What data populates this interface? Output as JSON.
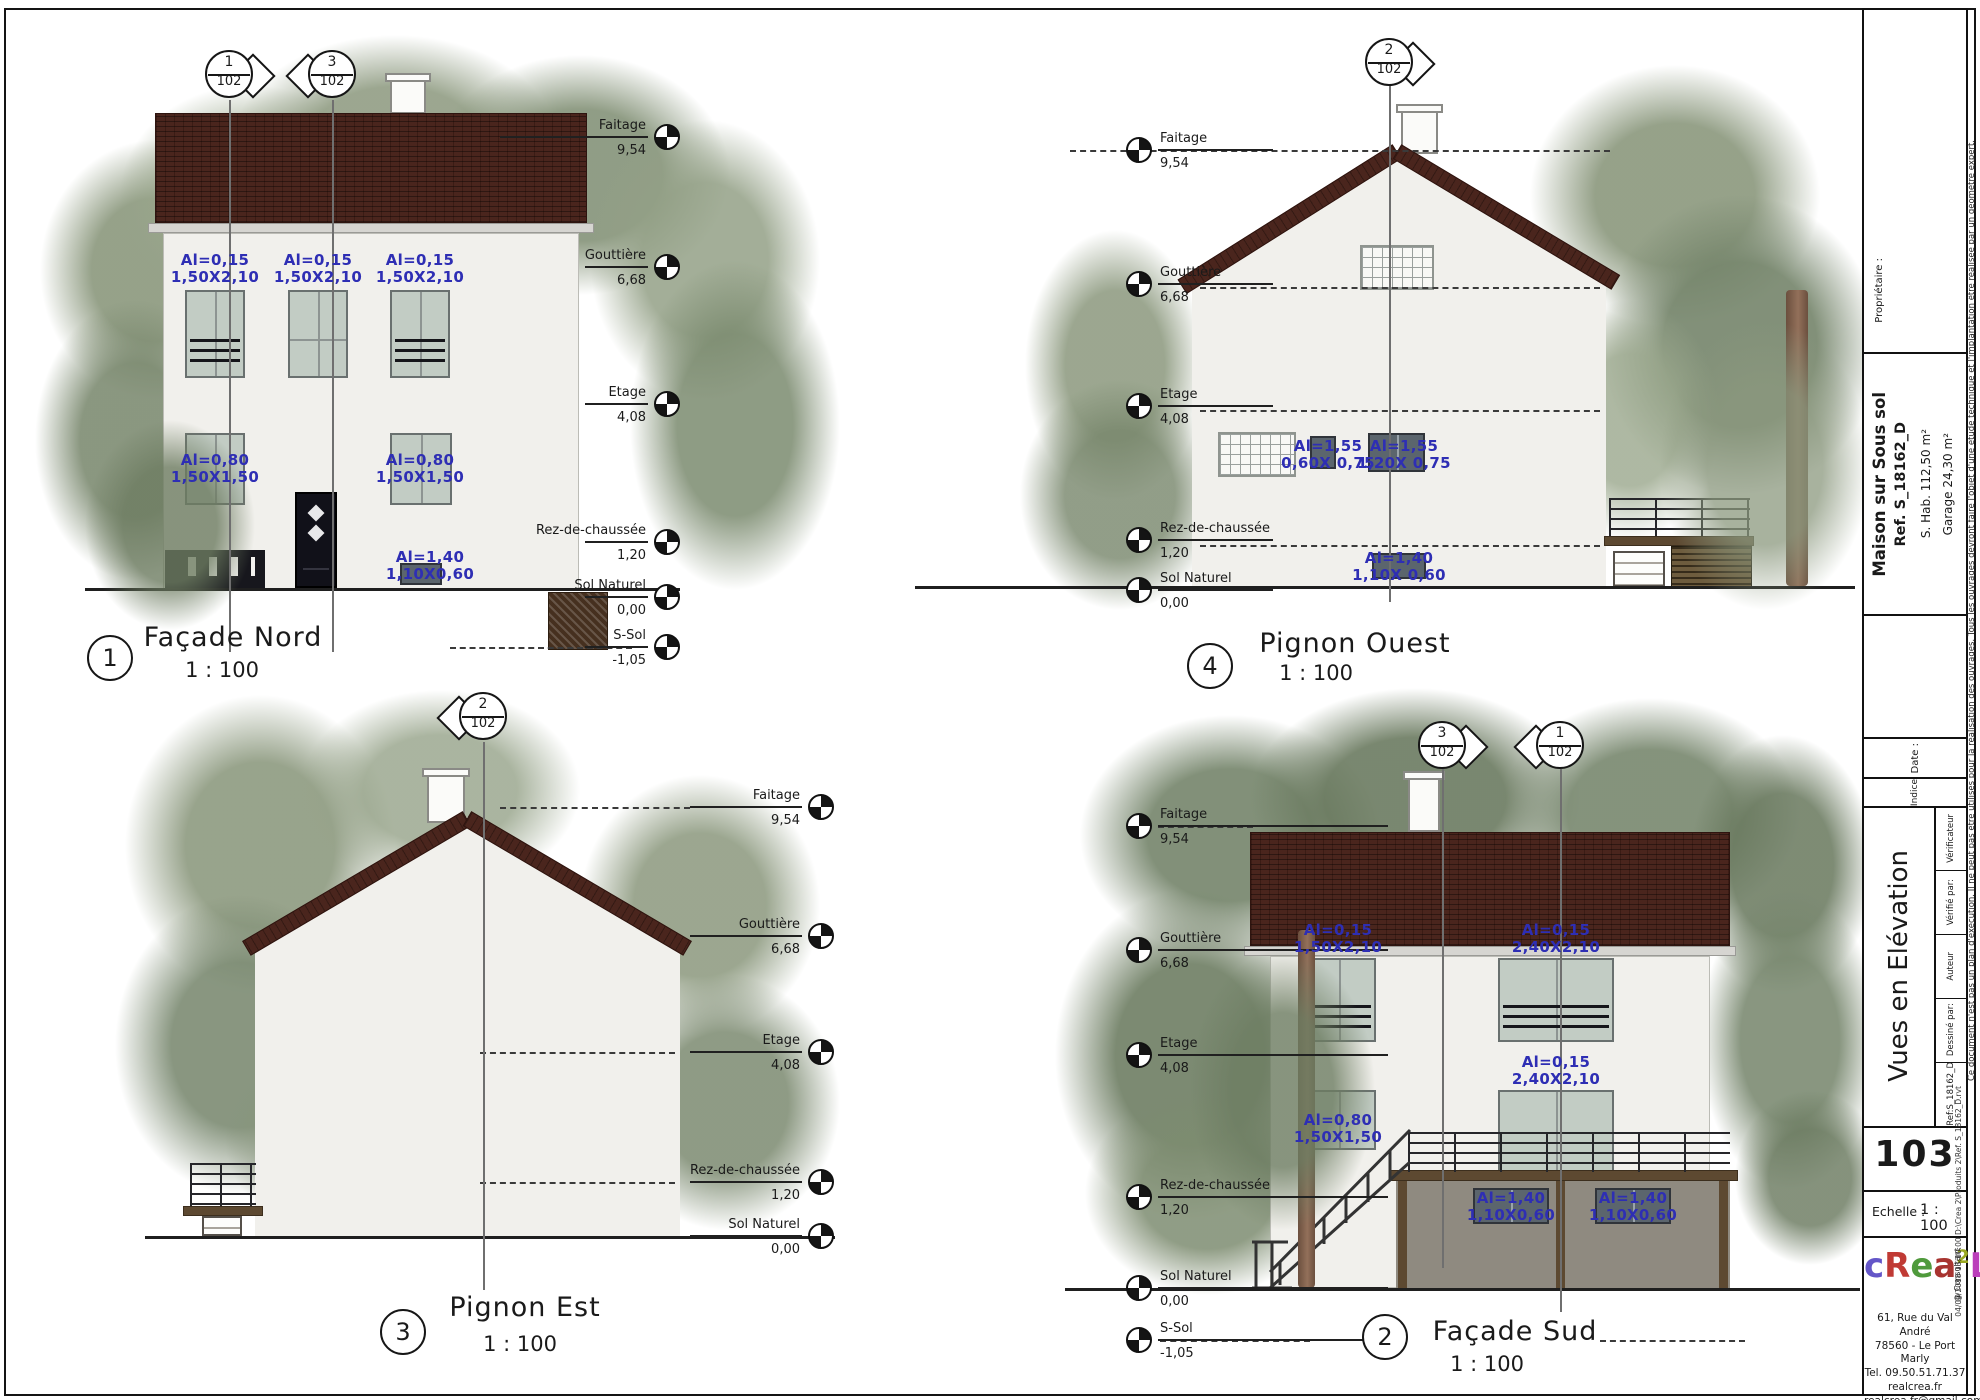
{
  "views": {
    "nord": {
      "number": "1",
      "title": "Façade Nord",
      "scale": "1 : 100",
      "markers": [
        {
          "num": "1",
          "den": "102"
        },
        {
          "num": "3",
          "den": "102"
        }
      ],
      "levels": [
        {
          "label": "Faitage",
          "value": "9,54"
        },
        {
          "label": "Gouttière",
          "value": "6,68"
        },
        {
          "label": "Etage",
          "value": "4,08"
        },
        {
          "label": "Rez-de-chaussée",
          "value": "1,20"
        },
        {
          "label": "Sol Naturel",
          "value": "0,00"
        },
        {
          "label": "S-Sol",
          "value": "-1,05"
        }
      ],
      "annotations": [
        {
          "l1": "Al=0,15",
          "l2": "1,50X2,10"
        },
        {
          "l1": "Al=0,15",
          "l2": "1,50X2,10"
        },
        {
          "l1": "Al=0,15",
          "l2": "1,50X2,10"
        },
        {
          "l1": "Al=0,80",
          "l2": "1,50X1,50"
        },
        {
          "l1": "Al=0,80",
          "l2": "1,50X1,50"
        },
        {
          "l1": "Al=1,40",
          "l2": "1,10X0,60"
        }
      ]
    },
    "ouest": {
      "number": "4",
      "title": "Pignon Ouest",
      "scale": "1 : 100",
      "markers": [
        {
          "num": "2",
          "den": "102"
        }
      ],
      "levels": [
        {
          "label": "Faitage",
          "value": "9,54"
        },
        {
          "label": "Gouttière",
          "value": "6,68"
        },
        {
          "label": "Etage",
          "value": "4,08"
        },
        {
          "label": "Rez-de-chaussée",
          "value": "1,20"
        },
        {
          "label": "Sol Naturel",
          "value": "0,00"
        }
      ],
      "annotations": [
        {
          "l1": "Al=1,55",
          "l2": "0,60X 0,75"
        },
        {
          "l1": "Al=1,55",
          "l2": "1,20X 0,75"
        },
        {
          "l1": "Al=1,40",
          "l2": "1,10X 0,60"
        }
      ]
    },
    "est": {
      "number": "3",
      "title": "Pignon Est",
      "scale": "1 : 100",
      "markers": [
        {
          "num": "2",
          "den": "102"
        }
      ],
      "levels": [
        {
          "label": "Faitage",
          "value": "9,54"
        },
        {
          "label": "Gouttière",
          "value": "6,68"
        },
        {
          "label": "Etage",
          "value": "4,08"
        },
        {
          "label": "Rez-de-chaussée",
          "value": "1,20"
        },
        {
          "label": "Sol Naturel",
          "value": "0,00"
        }
      ]
    },
    "sud": {
      "number": "2",
      "title": "Façade Sud",
      "scale": "1 : 100",
      "markers": [
        {
          "num": "3",
          "den": "102"
        },
        {
          "num": "1",
          "den": "102"
        }
      ],
      "levels": [
        {
          "label": "Faitage",
          "value": "9,54"
        },
        {
          "label": "Gouttière",
          "value": "6,68"
        },
        {
          "label": "Etage",
          "value": "4,08"
        },
        {
          "label": "Rez-de-chaussée",
          "value": "1,20"
        },
        {
          "label": "Sol Naturel",
          "value": "0,00"
        },
        {
          "label": "S-Sol",
          "value": "-1,05"
        }
      ],
      "annotations": [
        {
          "l1": "Al=0,15",
          "l2": "1,50X2,10"
        },
        {
          "l1": "Al=0,15",
          "l2": "2,40X2,10"
        },
        {
          "l1": "Al=0,15",
          "l2": "2,40X2,10"
        },
        {
          "l1": "Al=0,80",
          "l2": "1,50X1,50"
        },
        {
          "l1": "Al=1,40",
          "l2": "1,10X0,60"
        },
        {
          "l1": "Al=1,40",
          "l2": "1,10X0,60"
        }
      ]
    }
  },
  "titleblock": {
    "proprietaire_label": "Propriétaire :",
    "project": {
      "name": "Maison sur Sous sol",
      "ref": "Ref. S_18162_D",
      "shab": "S. Hab.   112,50 m²",
      "garage": "Garage   24,30 m²"
    },
    "date_label": "Date :",
    "indice_label": "Indice",
    "drawing_title": "Vues en Elévation",
    "roles": [
      "Vérificateur",
      "Vérifié par:",
      "Auteur",
      "Dessiné par:",
      "Ref:S_18162_D"
    ],
    "sheet_number": "103",
    "echelle_label": "Echelle :",
    "echelle_value": "1 : 100",
    "logo": {
      "letters": [
        {
          "ch": "c",
          "color": "#6456c8"
        },
        {
          "ch": "R",
          "color": "#c03a34"
        },
        {
          "ch": "e",
          "color": "#4f9a3c"
        },
        {
          "ch": "a",
          "color": "#a83430"
        },
        {
          "ch": "2",
          "color": "#9aa821"
        },
        {
          "ch": "L",
          "color": "#bb3fbb"
        }
      ],
      "consultant": "@ Consultant"
    },
    "address": [
      "61, Rue du Val André",
      "78560 - Le Port Marly",
      "Tel. 09.50.51.71.37",
      "realcrea.fr",
      "realcrea.fr@gmail.com"
    ],
    "disclaimer": "Ce document n'est pas un plan d'exécution. Il ne peut pas être utilisés pour la réalisation des ouvrages. Tous les ouvrages devront faire l'objet d'une étude technique et l'implantation être réalisée par un géomètre expert.",
    "file_info": "04/09/2018 13:10:00      D:\\Crea 2\\Produits 2\\Ref. S_18162_D.rvt"
  },
  "colors": {
    "annotation_blue": "#2e2eb4",
    "roof_brown": "#4a251d",
    "wall_grey": "#f1f0ec"
  }
}
